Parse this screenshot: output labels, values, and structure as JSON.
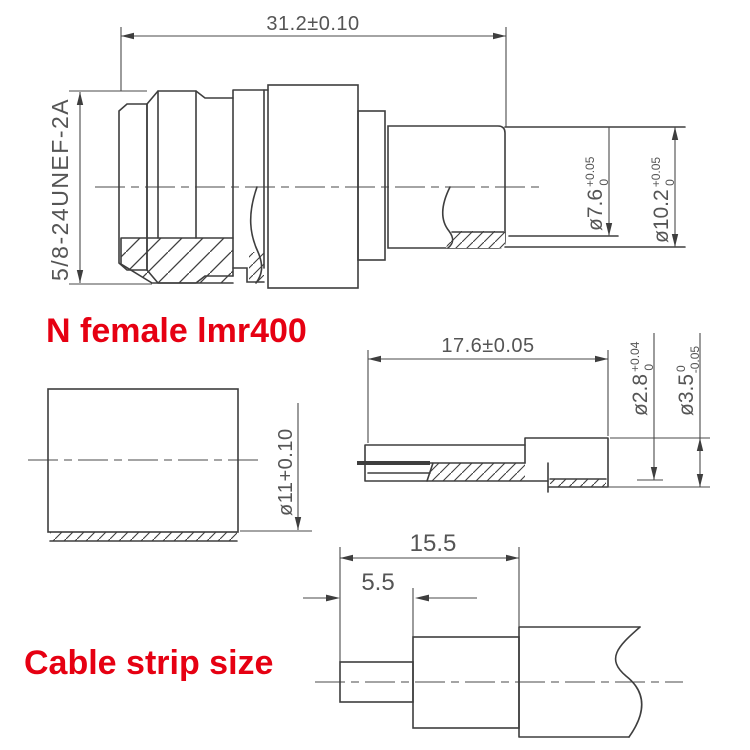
{
  "page": {
    "background": "#ffffff"
  },
  "colors": {
    "accent_red": "#e60012",
    "line": "#3e3e3e",
    "dim_text": "#555555"
  },
  "headings": {
    "connector": "N female lmr400",
    "cable": "Cable strip size"
  },
  "dims": {
    "overall_length": "31.2±0.10",
    "thread": "5/8-24UNEF-2A",
    "bore": {
      "main": "ø7.6",
      "sup": "+0.05",
      "sub": "0"
    },
    "body_od": {
      "main": "ø10.2",
      "sup": "+0.05",
      "sub": "0"
    },
    "pin_length": "17.6±0.05",
    "pin_od": {
      "main": "ø2.8",
      "sup": "+0.04",
      "sub": "0"
    },
    "collar_od": {
      "main": "ø3.5",
      "sup": "0",
      "sub": "-0.05"
    },
    "ferrule_id": "ø11+0.10",
    "strip_outer": "15.5",
    "strip_inner": "5.5"
  }
}
